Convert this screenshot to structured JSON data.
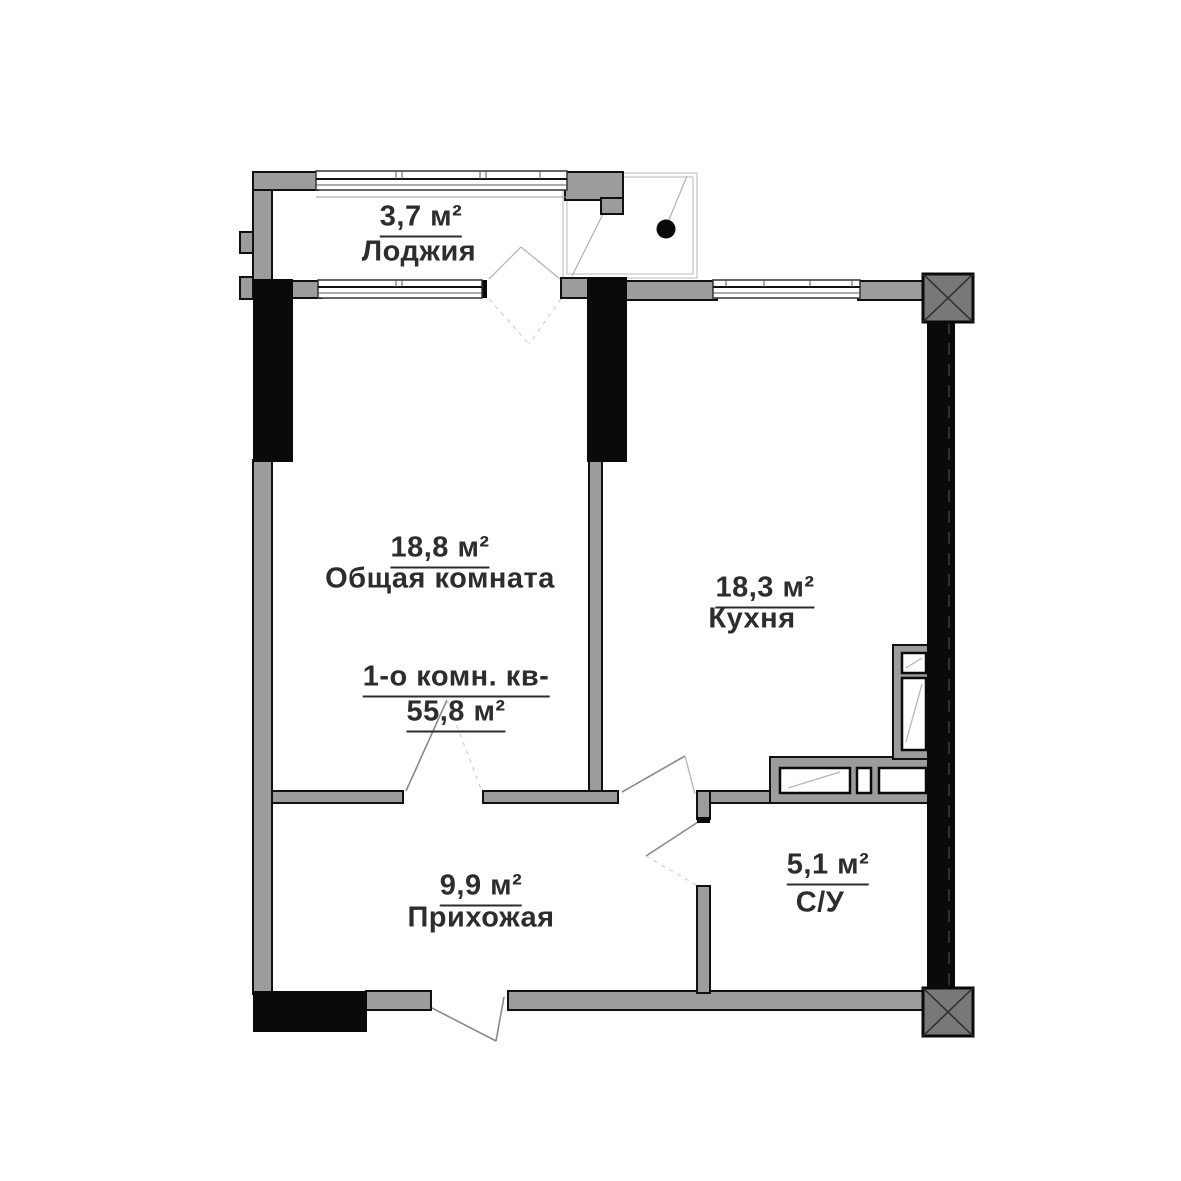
{
  "plan": {
    "summary": {
      "line1": "1-о комн. кв-",
      "line2": "55,8 м²"
    },
    "rooms": [
      {
        "id": "loggia",
        "name": "Лоджия",
        "area": "3,7 м²"
      },
      {
        "id": "living-room",
        "name": "Общая комната",
        "area": "18,8 м²"
      },
      {
        "id": "kitchen",
        "name": "Кухня",
        "area": "18,3 м²"
      },
      {
        "id": "hallway",
        "name": "Прихожая",
        "area": "9,9 м²"
      },
      {
        "id": "bathroom",
        "name": "С/У",
        "area": "5,1 м²"
      }
    ],
    "colors": {
      "wall_gray": "#9c9c9c",
      "wall_black": "#0a0a0a",
      "column_fill": "#787878",
      "text_color": "#2d2d2d",
      "sketch": "#b5b5b5"
    }
  }
}
